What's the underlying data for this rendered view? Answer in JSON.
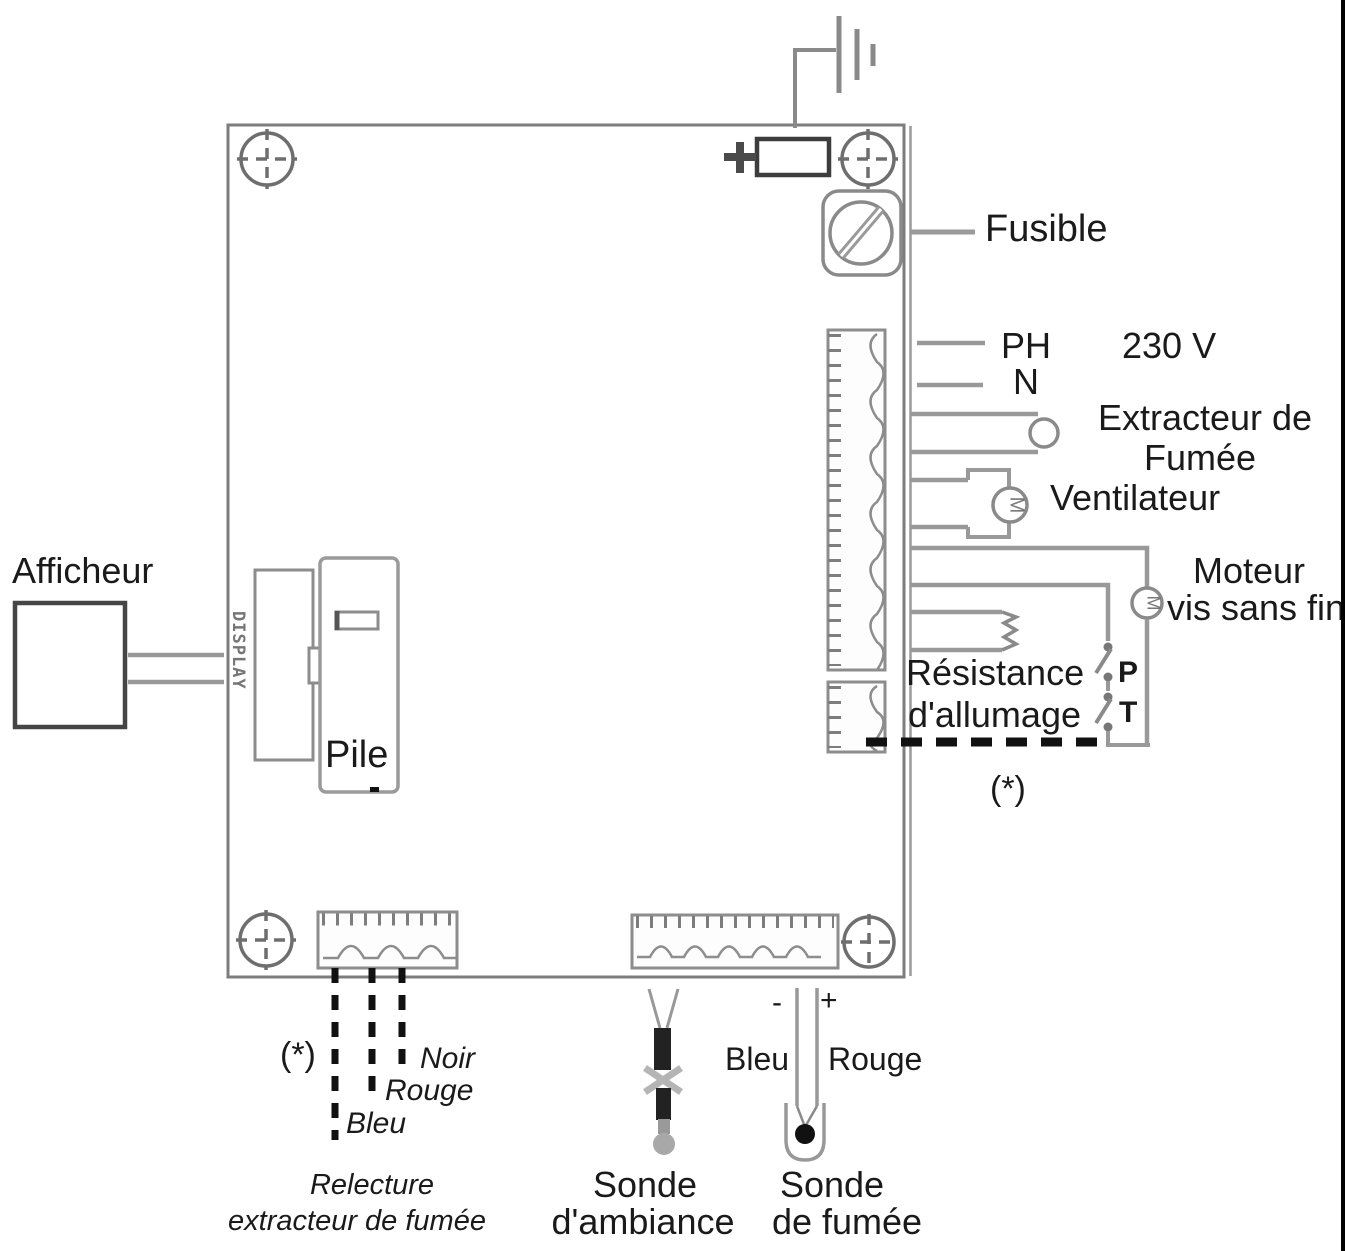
{
  "board": {
    "fuse_label": "Fusible",
    "display_connector_label": "DISPLAY",
    "battery_label": "Pile"
  },
  "left": {
    "display_unit_label": "Afficheur"
  },
  "power": {
    "phase": "PH",
    "neutral": "N",
    "voltage": "230 V"
  },
  "right": {
    "smoke_extractor_line1": "Extracteur de",
    "smoke_extractor_line2": "Fumée",
    "fan_label": "Ventilateur",
    "fan_symbol": "M",
    "auger_motor_line1": "Moteur",
    "auger_motor_line2": "vis sans fin",
    "auger_motor_symbol": "M",
    "igniter_line1": "Résistance",
    "igniter_line2": "d'allumage",
    "switch_p": "P",
    "switch_t": "T",
    "note_marker": "(*)"
  },
  "bottom": {
    "note_marker": "(*)",
    "wire_black": "Noir",
    "wire_red": "Rouge",
    "wire_blue": "Bleu",
    "readback_line1": "Relecture",
    "readback_line2": "extracteur de fumée",
    "smoke_probe_wire_blue": "Bleu",
    "smoke_probe_wire_red": "Rouge",
    "polarity_minus": "-",
    "polarity_plus": "+",
    "room_probe_line1": "Sonde",
    "room_probe_line2": "d'ambiance",
    "smoke_probe_line1": "Sonde",
    "smoke_probe_line2": "de fumée"
  },
  "colors": {
    "wire": "#999999",
    "outline": "#808080",
    "dashed_wire": "#111111",
    "text": "#1a1a1a",
    "page_border": "#000000"
  }
}
